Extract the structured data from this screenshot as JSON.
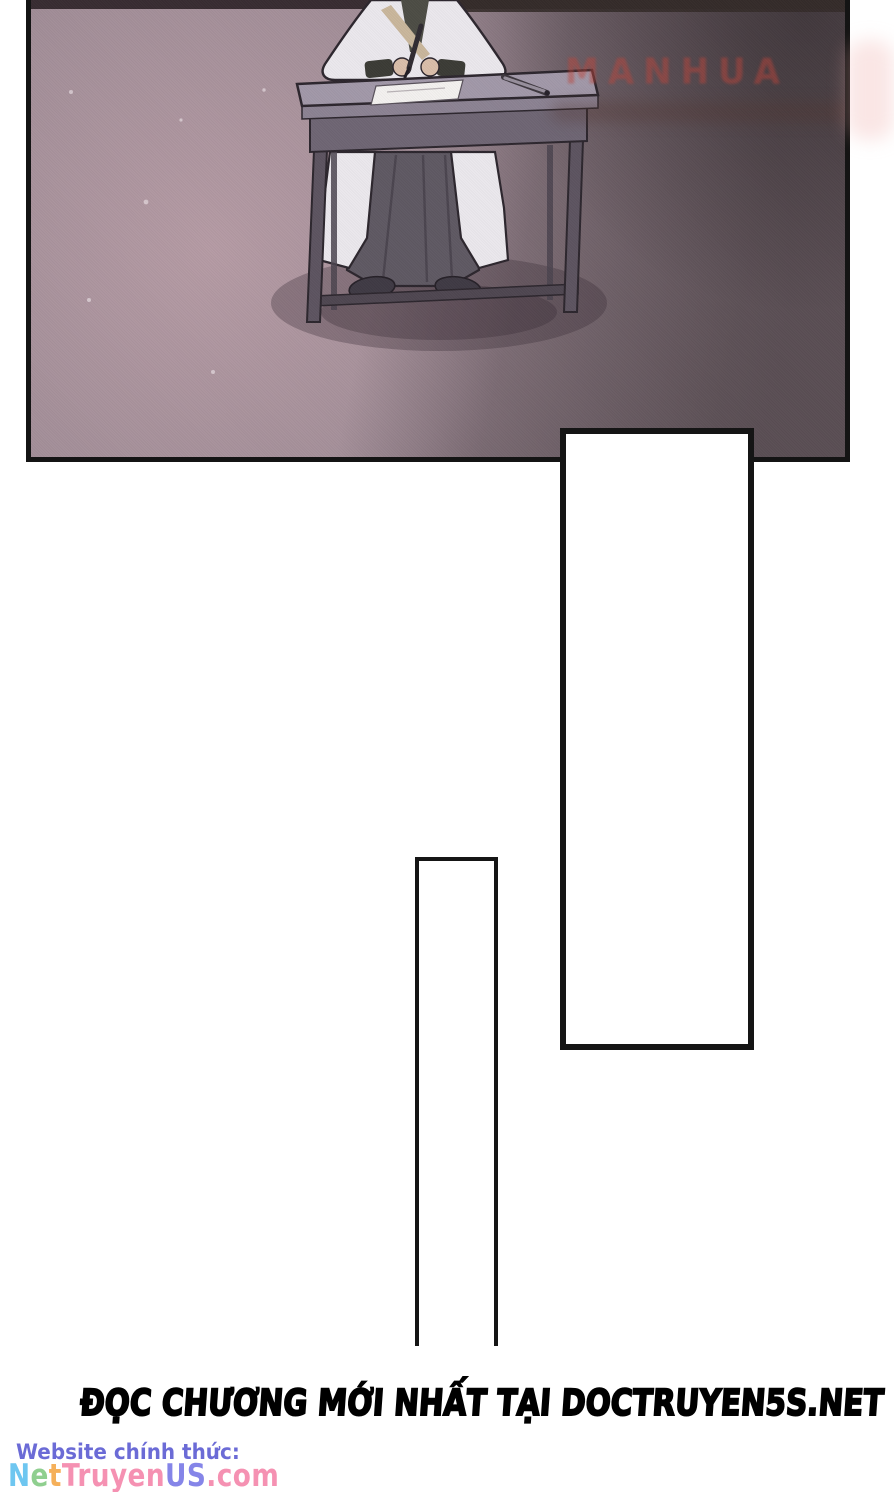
{
  "page": {
    "width": 894,
    "height": 1492,
    "background": "#ffffff"
  },
  "panel": {
    "watermark_text": "MANHUA"
  },
  "colors": {
    "page-bg": "#ffffff",
    "panel-border": "#141414",
    "floor-light": "#b59ba4",
    "floor-mid": "#a18d97",
    "floor-dark": "#7b6c75",
    "top-band": "#372b30",
    "desk-top": "#a198a8",
    "desk-face": "#8b8292",
    "desk-apron": "#6e6573",
    "desk-leg": "#5c535f",
    "desk-outline": "#2b252c",
    "robe": "#ebe8ed",
    "collar": "#4c4c44",
    "collar-trim": "#c9b69b",
    "skin": "#d9bda9",
    "skirt": "#5e5862",
    "skirt-fold": "#4a444e",
    "shoe": "#3e3943",
    "paper": "#f3f1ef",
    "shadow": "rgba(52,40,50,0.32)",
    "watermark": "rgba(190,66,56,0.48)",
    "smudge-dark": "rgba(80,50,44,0.32)",
    "smudge-pink": "rgba(238,172,168,0.30)",
    "bubble-border": "#151515",
    "official-label": "#6b6bd6"
  },
  "footer": {
    "promo_text": "ĐỌC CHƯƠNG MỚI NHẤT TẠI DOCTRUYEN5S.NET",
    "official_label": "Website chính thức:",
    "site": {
      "text": "NetTruyenUS.com",
      "letters": [
        {
          "ch": "N",
          "color": "#6ec6f0"
        },
        {
          "ch": "e",
          "color": "#8fcf8f"
        },
        {
          "ch": "t",
          "color": "#f5b05a"
        },
        {
          "ch": "T",
          "color": "#f591b2"
        },
        {
          "ch": "r",
          "color": "#f591b2"
        },
        {
          "ch": "u",
          "color": "#f591b2"
        },
        {
          "ch": "y",
          "color": "#f591b2"
        },
        {
          "ch": "e",
          "color": "#f591b2"
        },
        {
          "ch": "n",
          "color": "#f591b2"
        },
        {
          "ch": "U",
          "color": "#8585e8"
        },
        {
          "ch": "S",
          "color": "#8585e8"
        },
        {
          "ch": ".",
          "color": "#f591b2"
        },
        {
          "ch": "c",
          "color": "#f591b2"
        },
        {
          "ch": "o",
          "color": "#f591b2"
        },
        {
          "ch": "m",
          "color": "#f591b2"
        }
      ]
    }
  }
}
